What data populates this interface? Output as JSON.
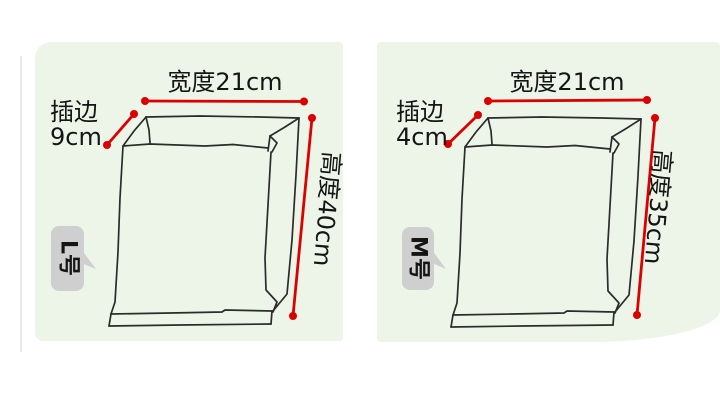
{
  "title": "paper bag size specification diagram",
  "colors": {
    "background": "#ffffff",
    "panel_green": "#edf5e9",
    "dimension_red": "#dd0000",
    "sketch_ink": "#2b2b2b",
    "bubble_gray": "#cfcfcf",
    "text": "#151515"
  },
  "panels": [
    {
      "size_tag": "L号",
      "width_label": "宽度21cm",
      "gusset_label_line1": "插边",
      "gusset_label_line2": "9cm",
      "height_label": "高度40cm",
      "dimensions": {
        "width_cm": 21,
        "gusset_cm": 9,
        "height_cm": 40
      }
    },
    {
      "size_tag": "M号",
      "width_label": "宽度21cm",
      "gusset_label_line1": "插边",
      "gusset_label_line2": "4cm",
      "height_label": "高度35cm",
      "dimensions": {
        "width_cm": 21,
        "gusset_cm": 4,
        "height_cm": 35
      }
    }
  ]
}
